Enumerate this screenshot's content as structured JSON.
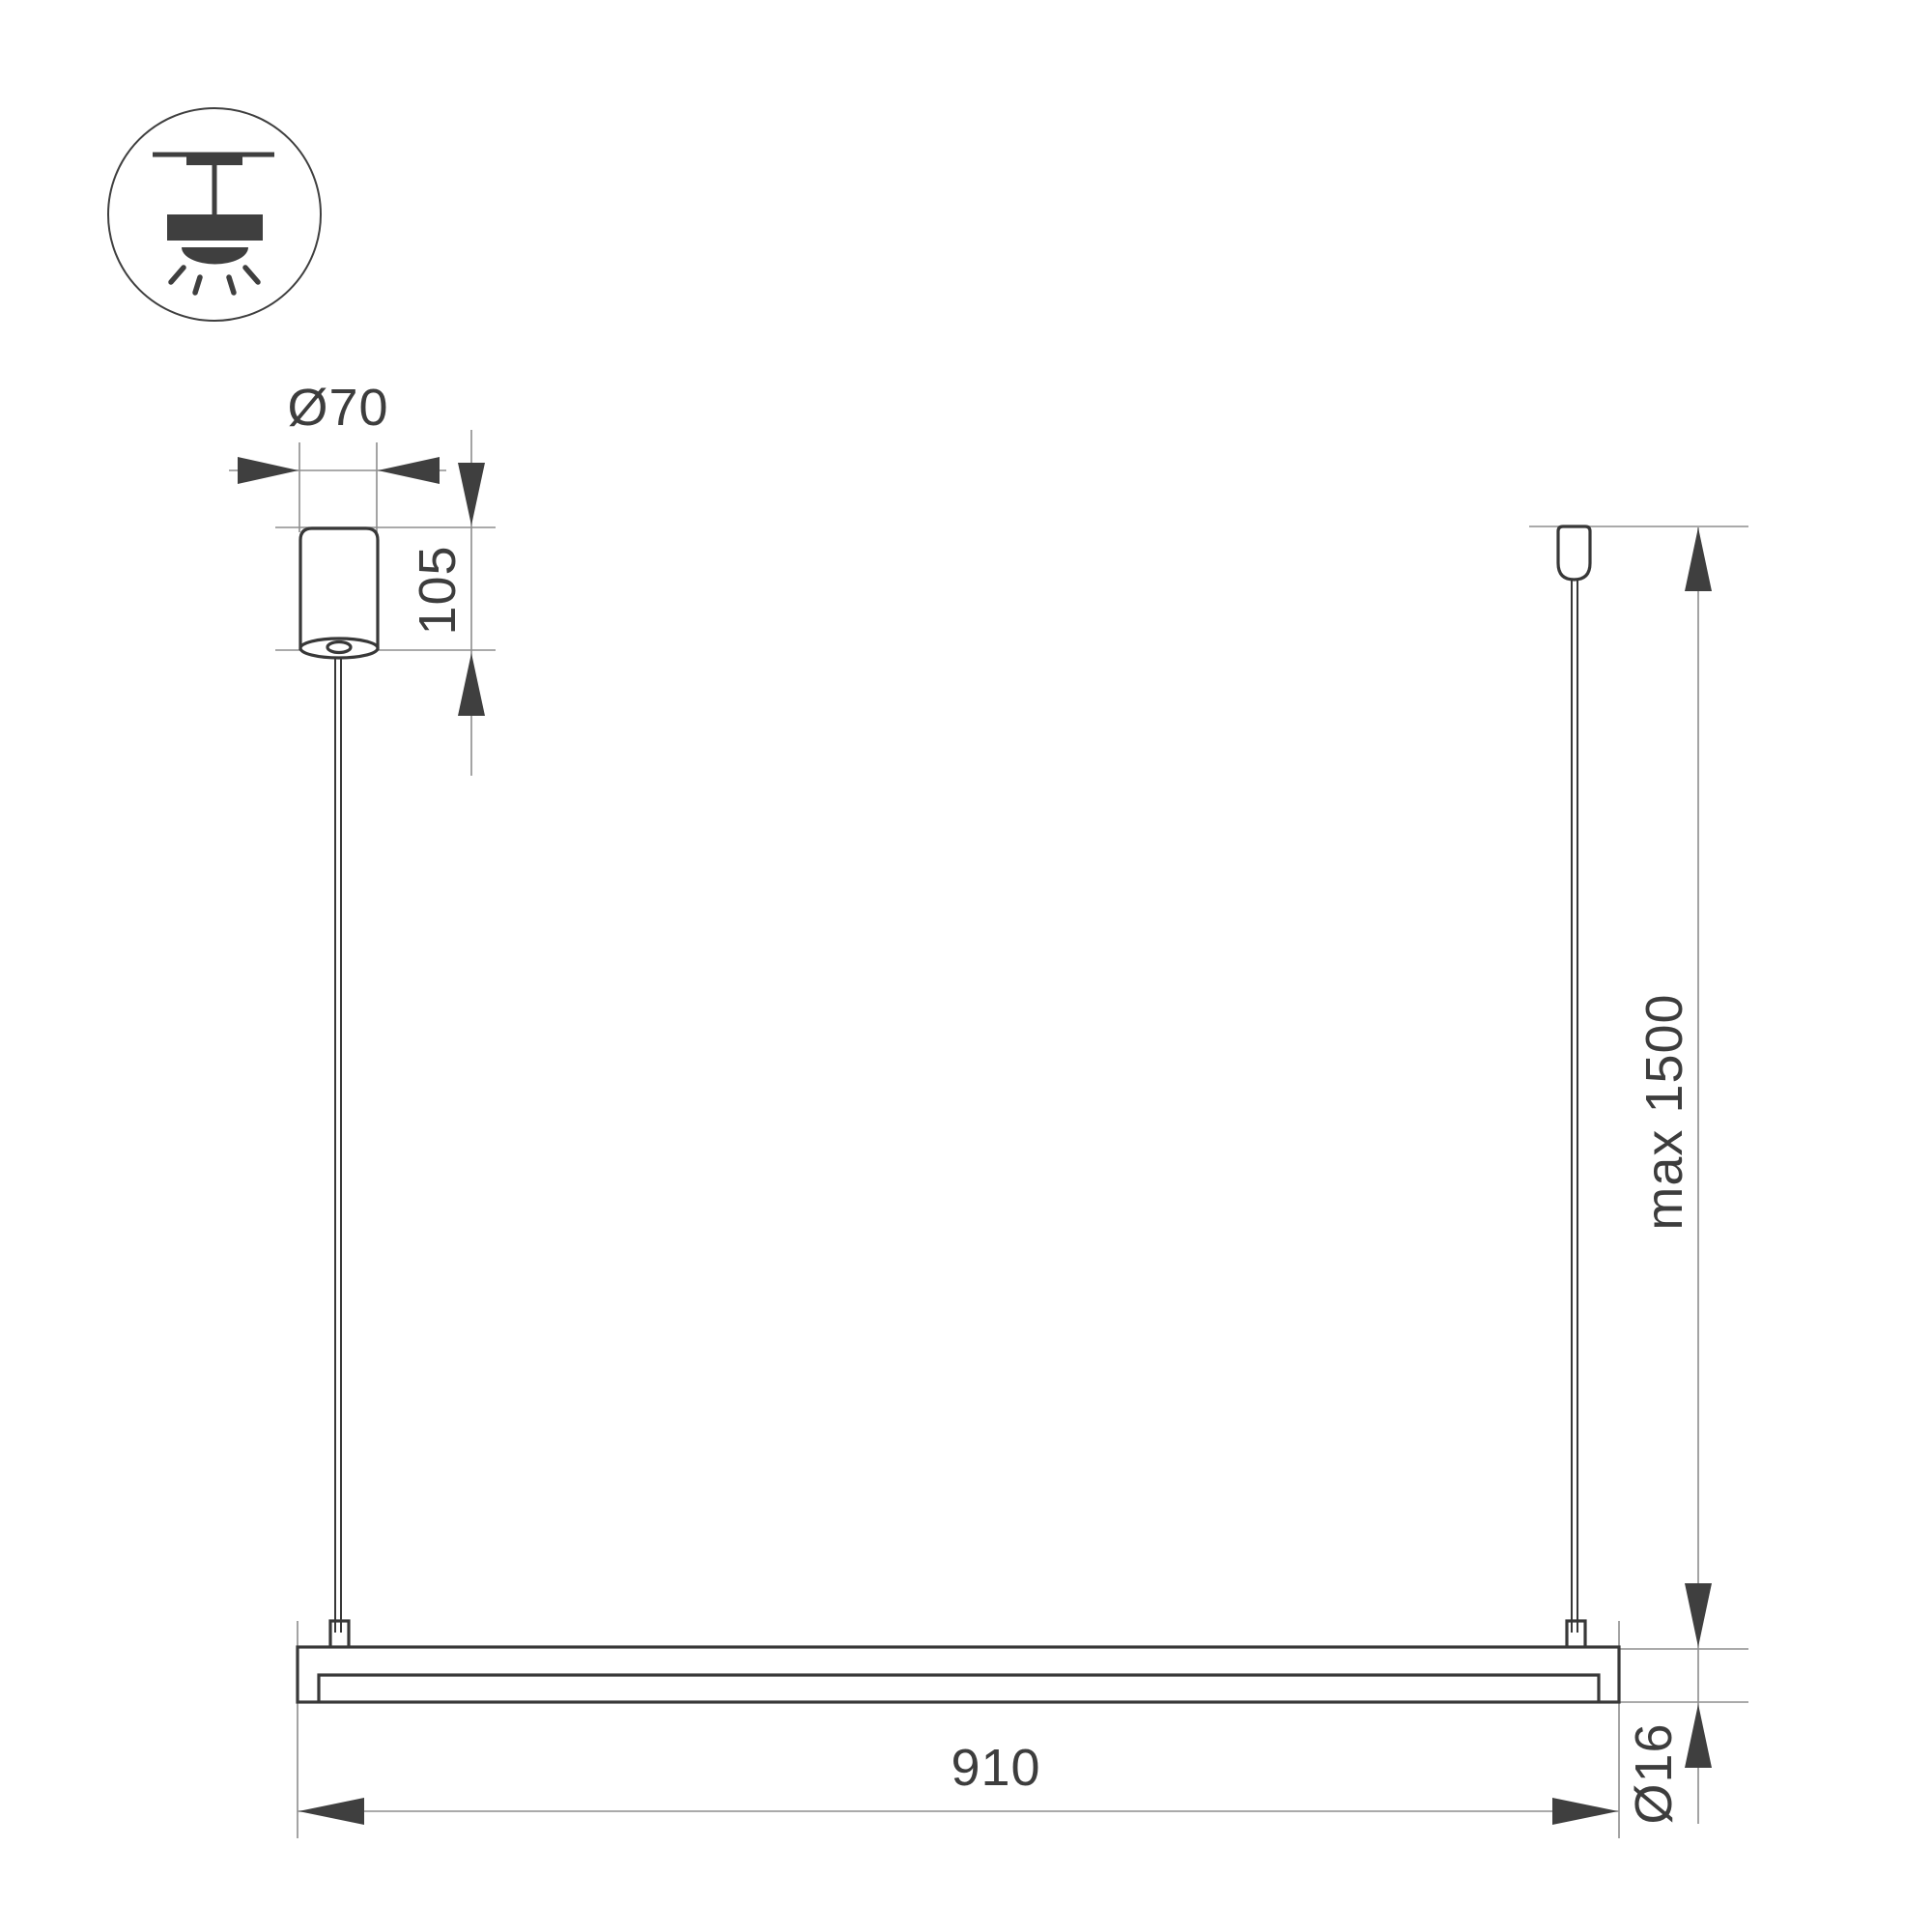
{
  "drawing": {
    "title": "pendant-light-fixture-dimension-drawing",
    "colors": {
      "background": "#ffffff",
      "object_line": "#383838",
      "thin_line": "#8e8e8e",
      "arrow": "#3f3f3f",
      "text": "#3d3d3d"
    },
    "icon": {
      "name": "ceiling-pendant-light-icon"
    },
    "labels": {
      "canopy_diameter": "Ø70",
      "canopy_height": "105",
      "max_suspension_height": "max 1500",
      "fixture_length": "910",
      "fixture_diameter": "Ø16"
    }
  }
}
